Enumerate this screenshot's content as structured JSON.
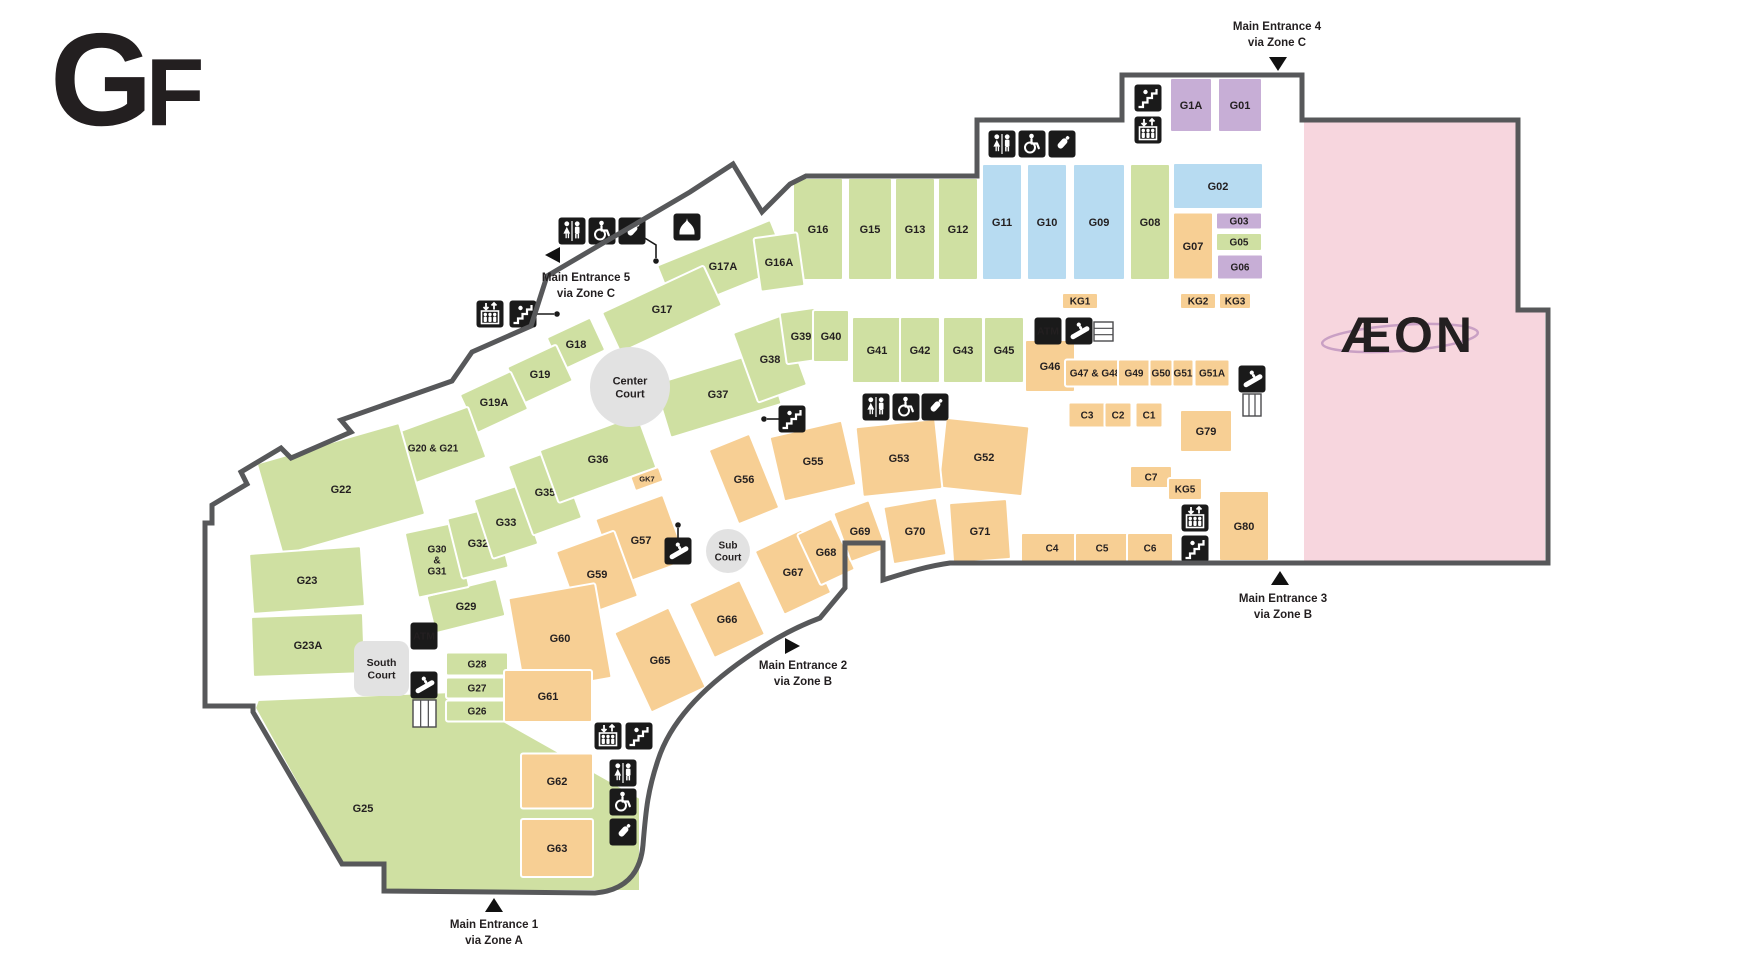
{
  "floor": {
    "big": "G",
    "small": "F"
  },
  "anchor": {
    "label": "ÆON"
  },
  "colors": {
    "green": "#cfe0a2",
    "blue": "#b7dbf1",
    "purple": "#c7aed6",
    "orange": "#f7cf94",
    "pink": "#f7d6de",
    "court": "#e2e2e2",
    "wall": "#57585a",
    "icon_bg": "#1a1a1a",
    "label": "#231f20",
    "aeon_magenta": "#a2298e",
    "aeon_ellipse": "#c9a0c4"
  },
  "atm_label": "ATM",
  "courts": [
    {
      "id": "center-court",
      "shape": "circle",
      "cx": 630,
      "cy": 387,
      "r": 40,
      "fs": 11,
      "lines": [
        "Center",
        "Court"
      ]
    },
    {
      "id": "sub-court",
      "shape": "circle",
      "cx": 728,
      "cy": 551,
      "r": 22,
      "fs": 10,
      "lines": [
        "Sub",
        "Court"
      ]
    },
    {
      "id": "south-court",
      "shape": "rect",
      "x": 354,
      "y": 641,
      "w": 55,
      "h": 55,
      "fs": 10.5,
      "lines": [
        "South",
        "Court"
      ]
    }
  ],
  "entrances": [
    {
      "id": 1,
      "lines": [
        "Main Entrance 1",
        "via Zone A"
      ],
      "tx": 494,
      "ty": 928,
      "dir": "up",
      "mx": 494,
      "my": 906
    },
    {
      "id": 2,
      "lines": [
        "Main Entrance 2",
        "via Zone B"
      ],
      "tx": 803,
      "ty": 669,
      "dir": "right",
      "mx": 791,
      "my": 646
    },
    {
      "id": 3,
      "lines": [
        "Main Entrance 3",
        "via Zone B"
      ],
      "tx": 1283,
      "ty": 602,
      "dir": "up",
      "mx": 1280,
      "my": 579
    },
    {
      "id": 4,
      "lines": [
        "Main Entrance 4",
        "via Zone C"
      ],
      "tx": 1277,
      "ty": 30,
      "dir": "down",
      "mx": 1278,
      "my": 63
    },
    {
      "id": 5,
      "lines": [
        "Main Entrance 5",
        "via Zone C"
      ],
      "tx": 586,
      "ty": 281,
      "dir": "left",
      "mx": 554,
      "my": 255
    }
  ],
  "units": [
    {
      "id": "G16",
      "c": "g",
      "x": 818,
      "y": 229,
      "w": 50,
      "h": 102
    },
    {
      "id": "G15",
      "c": "g",
      "x": 870,
      "y": 229,
      "w": 44,
      "h": 102
    },
    {
      "id": "G13",
      "c": "g",
      "x": 915,
      "y": 229,
      "w": 40,
      "h": 102
    },
    {
      "id": "G12",
      "c": "g",
      "x": 958,
      "y": 229,
      "w": 40,
      "h": 102
    },
    {
      "id": "G11",
      "c": "b",
      "x": 1002,
      "y": 222,
      "w": 40,
      "h": 116
    },
    {
      "id": "G10",
      "c": "b",
      "x": 1047,
      "y": 222,
      "w": 40,
      "h": 116
    },
    {
      "id": "G09",
      "c": "b",
      "x": 1099,
      "y": 222,
      "w": 52,
      "h": 116
    },
    {
      "id": "G08",
      "c": "g",
      "x": 1150,
      "y": 222,
      "w": 40,
      "h": 116
    },
    {
      "id": "G07",
      "c": "o",
      "x": 1193,
      "y": 246,
      "w": 40,
      "h": 67
    },
    {
      "id": "G02",
      "c": "b",
      "x": 1218,
      "y": 186,
      "w": 90,
      "h": 46
    },
    {
      "id": "G03",
      "c": "p",
      "x": 1239,
      "y": 221,
      "w": 46,
      "h": 17,
      "fs": 10
    },
    {
      "id": "G05",
      "c": "g",
      "x": 1239,
      "y": 242,
      "w": 46,
      "h": 18,
      "fs": 10
    },
    {
      "id": "G06",
      "c": "p",
      "x": 1240,
      "y": 267,
      "w": 46,
      "h": 25,
      "fs": 10
    },
    {
      "id": "G1A",
      "c": "p",
      "x": 1191,
      "y": 105,
      "w": 42,
      "h": 54
    },
    {
      "id": "G01",
      "c": "p",
      "x": 1240,
      "y": 105,
      "w": 44,
      "h": 54
    },
    {
      "id": "G17A",
      "c": "g",
      "x": 723,
      "y": 266,
      "w": 122,
      "h": 50,
      "r": -22
    },
    {
      "id": "G16A",
      "c": "g",
      "x": 779,
      "y": 262,
      "w": 44,
      "h": 54,
      "r": -8
    },
    {
      "id": "G17",
      "c": "g",
      "x": 662,
      "y": 309,
      "w": 112,
      "h": 44,
      "r": -25
    },
    {
      "id": "G18",
      "c": "g",
      "x": 576,
      "y": 344,
      "w": 48,
      "h": 36,
      "r": -25
    },
    {
      "id": "G19",
      "c": "g",
      "x": 540,
      "y": 374,
      "w": 54,
      "h": 40,
      "r": -25
    },
    {
      "id": "G19A",
      "c": "g",
      "x": 494,
      "y": 402,
      "w": 56,
      "h": 42,
      "r": -25
    },
    {
      "id": "G20 & G21",
      "c": "g",
      "x": 433,
      "y": 448,
      "w": 94,
      "h": 54,
      "r": -20,
      "fs": 10
    },
    {
      "id": "G22",
      "c": "g",
      "x": 341,
      "y": 489,
      "w": 148,
      "h": 95,
      "r": -16
    },
    {
      "id": "G23",
      "c": "g",
      "x": 307,
      "y": 580,
      "w": 112,
      "h": 60,
      "r": -4
    },
    {
      "id": "G23A",
      "c": "g",
      "x": 308,
      "y": 645,
      "w": 112,
      "h": 60,
      "r": -2
    },
    {
      "id": "G25",
      "c": "g",
      "poly": [
        [
          258,
          700
        ],
        [
          452,
          692
        ],
        [
          640,
          798
        ],
        [
          640,
          891
        ],
        [
          384,
          891
        ],
        [
          384,
          864
        ],
        [
          342,
          864
        ],
        [
          255,
          708
        ]
      ],
      "lx": 363,
      "ly": 808
    },
    {
      "id": "G26",
      "c": "g",
      "x": 477,
      "y": 711,
      "w": 62,
      "h": 21,
      "fs": 10
    },
    {
      "id": "G27",
      "c": "g",
      "x": 477,
      "y": 688,
      "w": 62,
      "h": 21,
      "fs": 10
    },
    {
      "id": "G28",
      "c": "g",
      "x": 477,
      "y": 664,
      "w": 62,
      "h": 23,
      "fs": 10
    },
    {
      "id": "G29",
      "c": "g",
      "x": 466,
      "y": 606,
      "w": 72,
      "h": 38,
      "r": -14
    },
    {
      "id": "G30 & G31",
      "c": "g",
      "x": 437,
      "y": 560,
      "w": 52,
      "h": 66,
      "r": -12,
      "fs": 10,
      "lines": [
        "G30",
        "&",
        "G31"
      ]
    },
    {
      "id": "G32",
      "c": "g",
      "x": 478,
      "y": 543,
      "w": 48,
      "h": 62,
      "r": -14
    },
    {
      "id": "G33",
      "c": "g",
      "x": 506,
      "y": 522,
      "w": 48,
      "h": 62,
      "r": -18
    },
    {
      "id": "G35",
      "c": "g",
      "x": 545,
      "y": 492,
      "w": 52,
      "h": 74,
      "r": -20
    },
    {
      "id": "G36",
      "c": "g",
      "x": 598,
      "y": 459,
      "w": 104,
      "h": 56,
      "r": -20
    },
    {
      "id": "G37",
      "c": "g",
      "x": 718,
      "y": 394,
      "w": 116,
      "h": 56,
      "r": -17
    },
    {
      "id": "G38",
      "c": "g",
      "x": 770,
      "y": 359,
      "w": 52,
      "h": 74,
      "r": -20
    },
    {
      "id": "G39",
      "c": "g",
      "x": 801,
      "y": 336,
      "w": 36,
      "h": 52,
      "r": -8
    },
    {
      "id": "G40",
      "c": "g",
      "x": 831,
      "y": 336,
      "w": 36,
      "h": 52
    },
    {
      "id": "G41",
      "c": "g",
      "x": 877,
      "y": 350,
      "w": 50,
      "h": 66
    },
    {
      "id": "G42",
      "c": "g",
      "x": 920,
      "y": 350,
      "w": 40,
      "h": 66
    },
    {
      "id": "G43",
      "c": "g",
      "x": 963,
      "y": 350,
      "w": 40,
      "h": 66
    },
    {
      "id": "G45",
      "c": "g",
      "x": 1004,
      "y": 350,
      "w": 40,
      "h": 66
    },
    {
      "id": "G46",
      "c": "o",
      "x": 1050,
      "y": 366,
      "w": 50,
      "h": 52
    },
    {
      "id": "G47 & G48",
      "c": "o",
      "x": 1095,
      "y": 373,
      "w": 60,
      "h": 27,
      "fs": 10
    },
    {
      "id": "G49",
      "c": "o",
      "x": 1134,
      "y": 373,
      "w": 32,
      "h": 27,
      "fs": 10
    },
    {
      "id": "G50",
      "c": "o",
      "x": 1161,
      "y": 373,
      "w": 23,
      "h": 27,
      "fs": 10
    },
    {
      "id": "G51",
      "c": "o",
      "x": 1183,
      "y": 373,
      "w": 21,
      "h": 27,
      "fs": 10
    },
    {
      "id": "G51A",
      "c": "o",
      "x": 1212,
      "y": 373,
      "w": 35,
      "h": 27,
      "fs": 10
    },
    {
      "id": "KG1",
      "c": "o",
      "x": 1080,
      "y": 301,
      "w": 36,
      "h": 16,
      "fs": 10
    },
    {
      "id": "KG2",
      "c": "o",
      "x": 1198,
      "y": 301,
      "w": 36,
      "h": 16,
      "fs": 10
    },
    {
      "id": "KG3",
      "c": "o",
      "x": 1235,
      "y": 301,
      "w": 32,
      "h": 16,
      "fs": 10
    },
    {
      "id": "C3",
      "c": "o",
      "x": 1087,
      "y": 415,
      "w": 37,
      "h": 25,
      "fs": 10
    },
    {
      "id": "C2",
      "c": "o",
      "x": 1118,
      "y": 415,
      "w": 27,
      "h": 25,
      "fs": 10
    },
    {
      "id": "C1",
      "c": "o",
      "x": 1149,
      "y": 415,
      "w": 27,
      "h": 25,
      "fs": 10
    },
    {
      "id": "G79",
      "c": "o",
      "x": 1206,
      "y": 431,
      "w": 52,
      "h": 42
    },
    {
      "id": "C7",
      "c": "o",
      "x": 1151,
      "y": 477,
      "w": 42,
      "h": 22,
      "fs": 10
    },
    {
      "id": "KG5",
      "c": "o",
      "x": 1185,
      "y": 489,
      "w": 34,
      "h": 22,
      "fs": 10
    },
    {
      "id": "C4",
      "c": "o",
      "x": 1052,
      "y": 548,
      "w": 62,
      "h": 30,
      "fs": 10
    },
    {
      "id": "C5",
      "c": "o",
      "x": 1102,
      "y": 548,
      "w": 54,
      "h": 30,
      "fs": 10
    },
    {
      "id": "C6",
      "c": "o",
      "x": 1150,
      "y": 548,
      "w": 46,
      "h": 30,
      "fs": 10
    },
    {
      "id": "G80",
      "c": "o",
      "x": 1244,
      "y": 526,
      "w": 50,
      "h": 70
    },
    {
      "id": "G52",
      "c": "o",
      "x": 984,
      "y": 457,
      "w": 84,
      "h": 70,
      "r": 6
    },
    {
      "id": "G53",
      "c": "o",
      "x": 899,
      "y": 458,
      "w": 80,
      "h": 70,
      "r": -6
    },
    {
      "id": "G55",
      "c": "o",
      "x": 813,
      "y": 461,
      "w": 74,
      "h": 66,
      "r": -13
    },
    {
      "id": "G56",
      "c": "o",
      "x": 744,
      "y": 479,
      "w": 44,
      "h": 80,
      "r": -22
    },
    {
      "id": "G57",
      "c": "o",
      "x": 641,
      "y": 540,
      "w": 72,
      "h": 70,
      "r": -20
    },
    {
      "id": "G59",
      "c": "o",
      "x": 597,
      "y": 574,
      "w": 62,
      "h": 70,
      "r": -20
    },
    {
      "id": "G60",
      "c": "o",
      "x": 560,
      "y": 638,
      "w": 88,
      "h": 96,
      "r": -10
    },
    {
      "id": "G61",
      "c": "o",
      "x": 548,
      "y": 696,
      "w": 88,
      "h": 52
    },
    {
      "id": "G62",
      "c": "o",
      "x": 557,
      "y": 781,
      "w": 72,
      "h": 55
    },
    {
      "id": "G63",
      "c": "o",
      "x": 557,
      "y": 848,
      "w": 72,
      "h": 58
    },
    {
      "id": "G65",
      "c": "o",
      "x": 660,
      "y": 660,
      "w": 60,
      "h": 88,
      "r": -25
    },
    {
      "id": "G66",
      "c": "o",
      "x": 727,
      "y": 619,
      "w": 56,
      "h": 60,
      "r": -25
    },
    {
      "id": "G67",
      "c": "o",
      "x": 793,
      "y": 572,
      "w": 52,
      "h": 70,
      "r": -25
    },
    {
      "id": "G68",
      "c": "o",
      "x": 826,
      "y": 552,
      "w": 38,
      "h": 56,
      "r": -25
    },
    {
      "id": "G69",
      "c": "o",
      "x": 860,
      "y": 531,
      "w": 38,
      "h": 52,
      "r": -20
    },
    {
      "id": "G70",
      "c": "o",
      "x": 915,
      "y": 531,
      "w": 54,
      "h": 58,
      "r": -10
    },
    {
      "id": "G71",
      "c": "o",
      "x": 980,
      "y": 531,
      "w": 58,
      "h": 60,
      "r": -4
    },
    {
      "id": "GK7",
      "c": "o",
      "x": 647,
      "y": 479,
      "w": 30,
      "h": 15,
      "r": -20,
      "fs": 7.5
    }
  ],
  "aeon_block": {
    "poly": [
      [
        1304,
        120
      ],
      [
        1517,
        120
      ],
      [
        1517,
        310
      ],
      [
        1545,
        310
      ],
      [
        1545,
        561
      ],
      [
        1304,
        561
      ]
    ],
    "logo_x": 1408,
    "logo_y": 352,
    "ellipse": [
      1400,
      338,
      78,
      13
    ]
  },
  "icons": [
    {
      "t": "toilets",
      "x": 572,
      "y": 231
    },
    {
      "t": "accessible",
      "x": 602,
      "y": 231
    },
    {
      "t": "nursing-room",
      "x": 632,
      "y": 231
    },
    {
      "t": "prayer-room",
      "x": 687,
      "y": 227
    },
    {
      "t": "toilets",
      "x": 1002,
      "y": 144
    },
    {
      "t": "accessible",
      "x": 1032,
      "y": 144
    },
    {
      "t": "nursing-room",
      "x": 1062,
      "y": 144
    },
    {
      "t": "stairs",
      "x": 1148,
      "y": 98
    },
    {
      "t": "elevator",
      "x": 1148,
      "y": 130
    },
    {
      "t": "atm",
      "x": 1048,
      "y": 331
    },
    {
      "t": "escalator",
      "x": 1079,
      "y": 331
    },
    {
      "t": "toilets",
      "x": 876,
      "y": 407
    },
    {
      "t": "accessible",
      "x": 906,
      "y": 407
    },
    {
      "t": "nursing-room",
      "x": 935,
      "y": 407
    },
    {
      "t": "stairs",
      "x": 792,
      "y": 419
    },
    {
      "t": "escalator",
      "x": 678,
      "y": 551
    },
    {
      "t": "escalator",
      "x": 1252,
      "y": 379
    },
    {
      "t": "elevator",
      "x": 1195,
      "y": 518
    },
    {
      "t": "stairs",
      "x": 1195,
      "y": 549
    },
    {
      "t": "elevator",
      "x": 490,
      "y": 314
    },
    {
      "t": "stairs",
      "x": 523,
      "y": 314
    },
    {
      "t": "atm",
      "x": 424,
      "y": 636
    },
    {
      "t": "escalator",
      "x": 424,
      "y": 685
    },
    {
      "t": "elevator",
      "x": 608,
      "y": 736
    },
    {
      "t": "stairs",
      "x": 639,
      "y": 736
    },
    {
      "t": "toilets",
      "x": 623,
      "y": 773
    },
    {
      "t": "accessible",
      "x": 623,
      "y": 802
    },
    {
      "t": "nursing-room",
      "x": 623,
      "y": 832
    }
  ],
  "connectors": [
    {
      "pts": [
        [
          537,
          314
        ],
        [
          554,
          314
        ]
      ],
      "dot": [
        557,
        314
      ]
    },
    {
      "pts": [
        [
          643,
          237
        ],
        [
          656,
          245
        ],
        [
          656,
          258
        ]
      ],
      "dot": [
        656,
        261
      ]
    },
    {
      "pts": [
        [
          779,
          419
        ],
        [
          767,
          419
        ]
      ],
      "dot": [
        764,
        419
      ]
    },
    {
      "pts": [
        [
          678,
          538
        ],
        [
          678,
          528
        ]
      ],
      "dot": [
        678,
        525
      ]
    }
  ],
  "fixtures": [
    {
      "x": 1094,
      "y": 322,
      "w": 19,
      "h": 19,
      "o": "h"
    },
    {
      "x": 1243,
      "y": 394,
      "w": 18,
      "h": 22,
      "o": "v"
    },
    {
      "x": 413,
      "y": 700,
      "w": 23,
      "h": 27,
      "o": "v"
    }
  ],
  "walls": [
    "M1302,75 L1122,75 L1122,120 L977,120 L977,176 L806,176 L790,184 L762,212 L733,164 L690,192 L547,276 L531,326 L472,352 L452,381 L341,420 L351,432 L291,458 L281,448 L241,472 L247,484 L212,505 L212,523 L205,523 L205,706 L253,706 L253,712 L342,864 L384,864 L384,891 L595,893 C630,890 641,868 643,845 C646,808 648,790 658,760 C670,723 700,690 746,658 C770,641 796,627 820,618 L845,588 L845,543 L883,543 L883,580 C908,572 928,566 950,563 L1548,563 L1548,310 L1518,310 L1518,120 L1302,120 Z"
  ]
}
